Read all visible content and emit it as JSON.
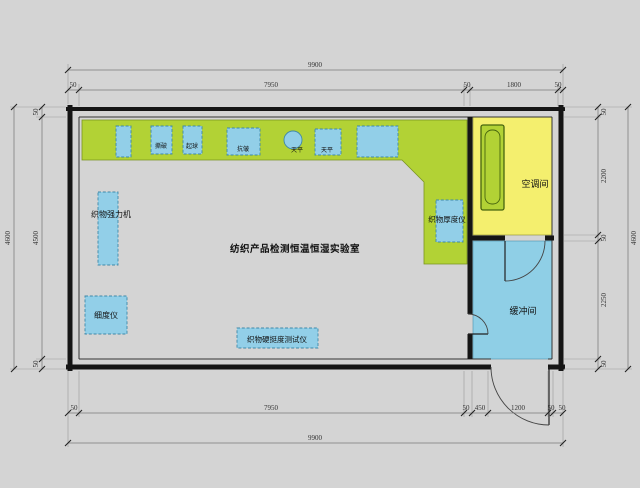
{
  "drawing": {
    "lab_label": "纺织产品检测恒温恒湿实验室",
    "ac_room_label": "空调间",
    "buffer_room_label": "缓冲间",
    "equipment": {
      "strength_tester": "织物强力机",
      "fineness_tester": "细度仪",
      "stiffness_tester": "织物硬挺度测试仪",
      "thickness_tester": "织物厚度仪",
      "bench_items": [
        "撕破",
        "起球",
        "抗皱",
        "天平",
        "天平"
      ]
    },
    "dimensions": {
      "top_overall": "9900",
      "top_segments": [
        "50",
        "7950",
        "50",
        "1800",
        "50"
      ],
      "bottom_segments": [
        "50",
        "7950",
        "50",
        "450",
        "1200",
        "50",
        "50"
      ],
      "bottom_overall": "9900",
      "left_outer": "4600",
      "left_segments": [
        "50",
        "4500",
        "50"
      ],
      "right_segments": [
        "50",
        "2200",
        "50",
        "2250",
        "50"
      ],
      "right_outer": "4600"
    },
    "colors": {
      "background": "#d4d4d4",
      "bench_green": "#b2d235",
      "equipment_blue": "#92cfe8",
      "ac_room_yellow": "#f4ef6e",
      "buffer_room_blue": "#8fcfe6",
      "ac_unit_green": "#b2d235",
      "wall": "#151515"
    }
  }
}
